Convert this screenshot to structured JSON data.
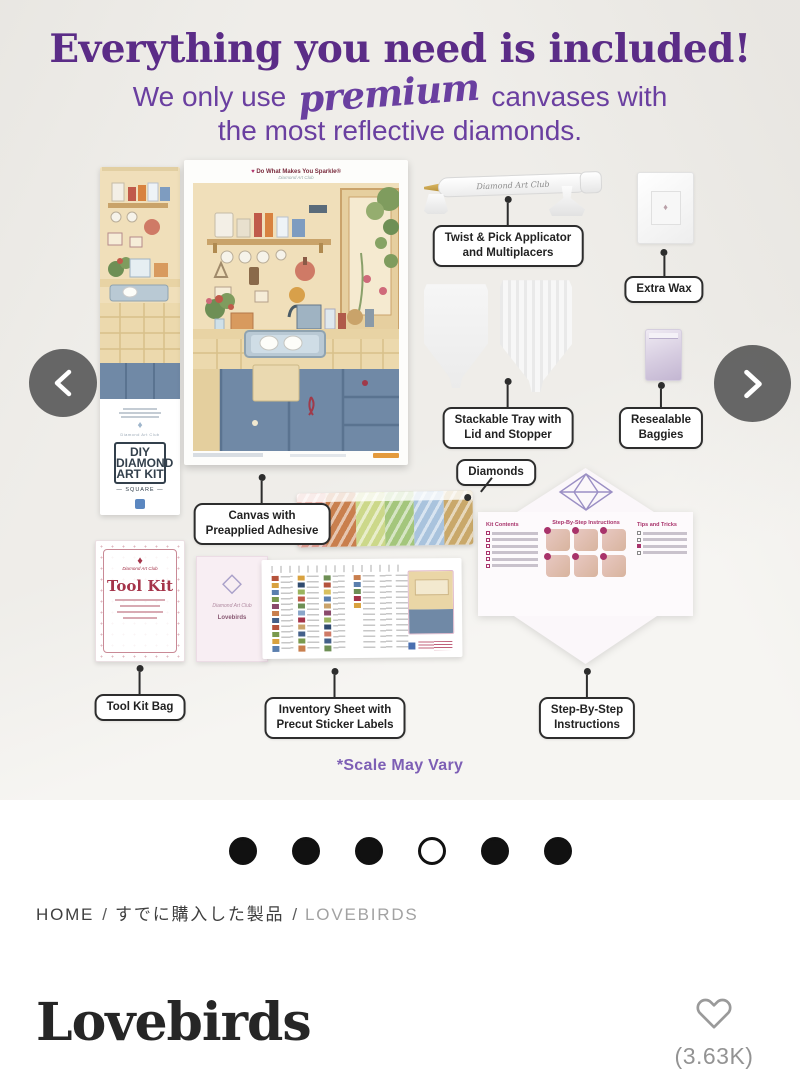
{
  "hero": {
    "heading": "Everything you need is included!",
    "subtitle_pre": "We only use",
    "subtitle_script": "premium",
    "subtitle_post": "canvases with",
    "subtitle_line2": "the most reflective diamonds.",
    "scale_note": "*Scale May Vary",
    "accent_color": "#5b2c87"
  },
  "callouts": {
    "applicator": "Twist & Pick Applicator\nand Multiplacers",
    "extra_wax": "Extra Wax",
    "tray": "Stackable Tray with\nLid and Stopper",
    "baggies": "Resealable\nBaggies",
    "canvas": "Canvas with\nPreapplied Adhesive",
    "diamonds": "Diamonds",
    "tool_kit": "Tool Kit Bag",
    "inventory": "Inventory Sheet with\nPrecut Sticker Labels",
    "instructions": "Step-By-Step\nInstructions"
  },
  "artwork": {
    "canvas_header": "Do What Makes You Sparkle®",
    "brand_script": "Diamond Art Club",
    "box_diy": "DIY\nDIAMOND\nART KIT",
    "box_square": "— SQUARE —",
    "box_all_inclusive": "ALL INCLUSIVE",
    "tool_kit_title": "Tool Kit",
    "insert_title": "Lovebirds",
    "instr_kit_contents": "Kit Contents",
    "instr_steps_title": "Step-By-Step Instructions",
    "instr_tips_title": "Tips and Tricks",
    "diamond_bag_colors": [
      "#e2a095",
      "#c97f4e",
      "#ccd88a",
      "#a4c67c",
      "#a9c3dd",
      "#c9a86a"
    ]
  },
  "carousel": {
    "dots_total": 6,
    "active_index": 3
  },
  "icons": {
    "prev": "chevron-left",
    "next": "chevron-right",
    "favorite": "heart-outline"
  },
  "breadcrumb": {
    "separator": "/",
    "items": [
      {
        "label": "HOME"
      },
      {
        "label": "すでに購入した製品"
      },
      {
        "label": "LOVEBIRDS"
      }
    ]
  },
  "product": {
    "title": "Lovebirds",
    "likes_count": "(3.63K)"
  }
}
